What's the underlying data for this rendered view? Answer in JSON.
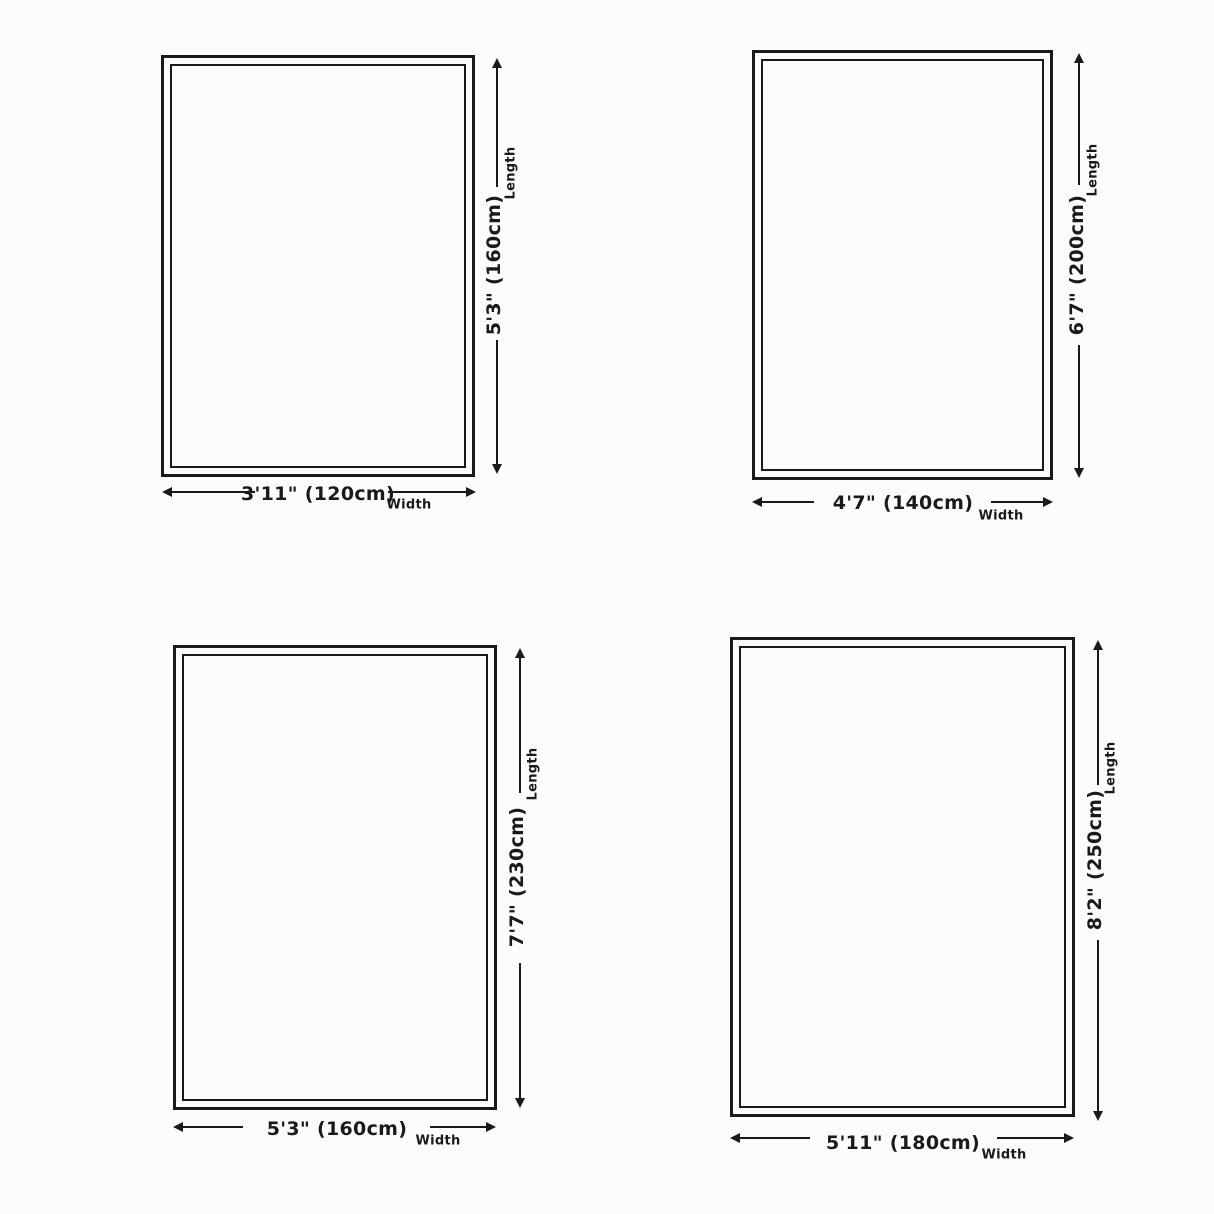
{
  "diagram": {
    "title": "rug-size-diagram",
    "background": "#fcfcfc",
    "line_color": "#1a1a1a"
  },
  "rugs": [
    {
      "name": "rug-120x160",
      "width_cm": 120,
      "length_cm": 160,
      "width": {
        "label": "3'11\" (120cm)",
        "caption": "Width"
      },
      "length": {
        "label": "5'3\" (160cm)",
        "caption": "Length"
      }
    },
    {
      "name": "rug-140x200",
      "width_cm": 140,
      "length_cm": 200,
      "width": {
        "label": "4'7\" (140cm)",
        "caption": "Width"
      },
      "length": {
        "label": "6'7\" (200cm)",
        "caption": "Length"
      }
    },
    {
      "name": "rug-160x230",
      "width_cm": 160,
      "length_cm": 230,
      "width": {
        "label": "5'3\" (160cm)",
        "caption": "Width"
      },
      "length": {
        "label": "7'7\" (230cm)",
        "caption": "Length"
      }
    },
    {
      "name": "rug-180x250",
      "width_cm": 180,
      "length_cm": 250,
      "width": {
        "label": "5'11\" (180cm)",
        "caption": "Width"
      },
      "length": {
        "label": "8'2\" (250cm)",
        "caption": "Length"
      }
    }
  ]
}
